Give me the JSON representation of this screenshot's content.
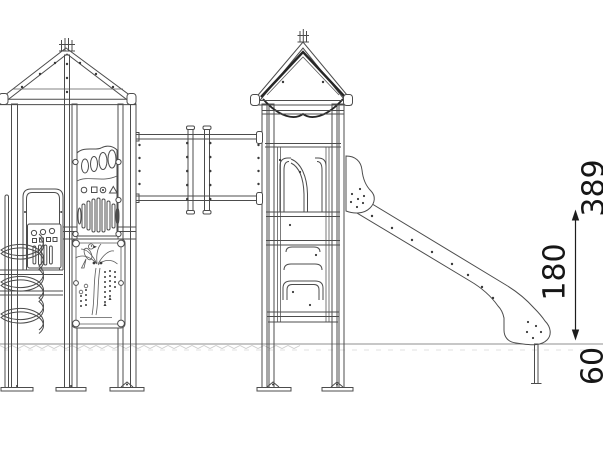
{
  "dimensions": {
    "overall_height": "389",
    "platform_height": "180",
    "foundation_depth": "60"
  },
  "colors": {
    "line": "#4c4c4c",
    "dark_line": "#262626",
    "dimension": "#1d1d1d",
    "ground": "#8f8f8f",
    "hatch": "#cccccc",
    "background": "#ffffff"
  }
}
